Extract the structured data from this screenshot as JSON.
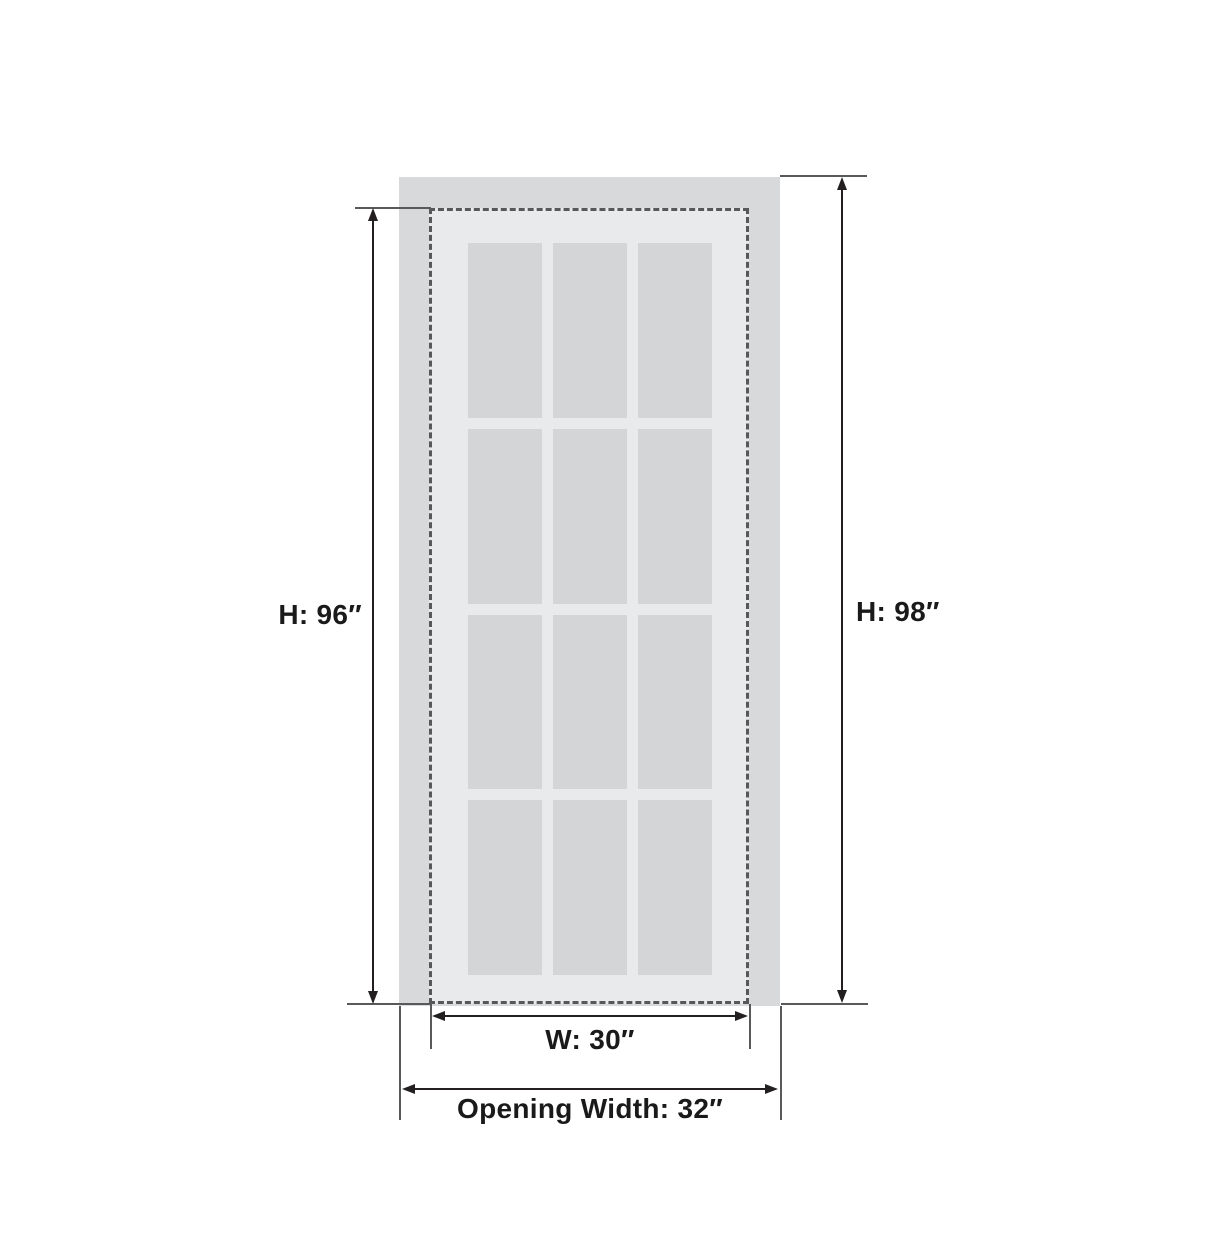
{
  "diagram": {
    "type": "door-dimension-diagram",
    "background": "#ffffff",
    "labels": {
      "door_height": "H: 96″",
      "opening_height": "H: 98″",
      "door_width": "W: 30″",
      "opening_width": "Opening Width: 32″"
    },
    "values": {
      "door_height_in": 96,
      "opening_height_in": 98,
      "door_width_in": 30,
      "opening_width_in": 32
    },
    "glass_grid": {
      "columns": 3,
      "rows": 4,
      "pane_count": 12
    },
    "colors": {
      "opening_fill": "#d8d9da",
      "door_face_fill": "#e9eaeb",
      "glass_pane_fill": "#d4d5d6",
      "door_outline_dash": "#57585a",
      "dimension_line": "#231f20",
      "extension_line": "#58595b",
      "label_text": "#1a1a1a"
    }
  }
}
